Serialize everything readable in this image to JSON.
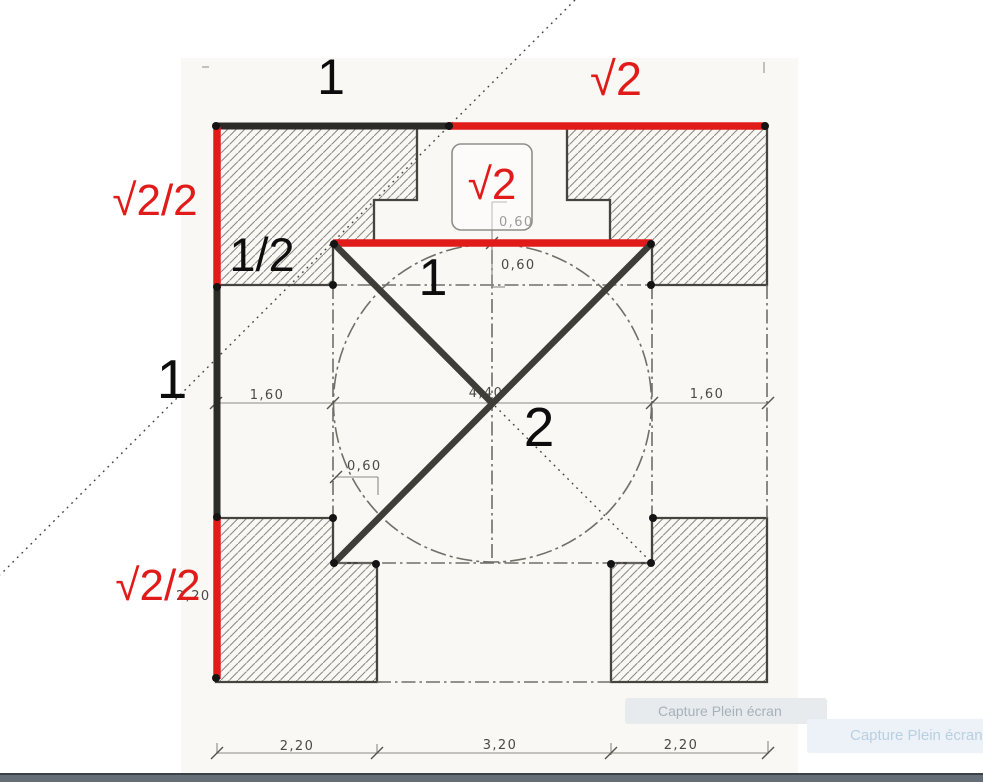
{
  "title": "Plan geometry analysis (square, circle and diagonals) with proportion annotations",
  "colors": {
    "paper": "#faf8f4",
    "annotation_red": "#e11a1a",
    "annotation_black": "#2b2b28",
    "diagonal_dark": "#3e3d38",
    "block_outline": "#45453f",
    "hatch_line": "#8b8b84",
    "dashdot": "#6f6f68",
    "thin_dim": "#8a8a83",
    "dim_text": "#4a4a45",
    "dot": "#141414"
  },
  "math_labels": [
    {
      "name": "label-one-top",
      "text": "1",
      "x": 331,
      "y": 94,
      "size": 50,
      "color": "black"
    },
    {
      "name": "label-sqrt2-top",
      "text": "√2",
      "x": 616,
      "y": 95,
      "size": 47,
      "color": "red"
    },
    {
      "name": "label-sqrt2-half-upper",
      "text": "√2/2",
      "x": 155,
      "y": 215,
      "size": 44,
      "color": "red"
    },
    {
      "name": "label-one-half",
      "text": "1/2",
      "x": 262,
      "y": 271,
      "size": 47,
      "color": "black"
    },
    {
      "name": "label-sqrt2-boxed",
      "text": "√2",
      "x": 492,
      "y": 199,
      "size": 44,
      "color": "red"
    },
    {
      "name": "label-one-inner",
      "text": "1",
      "x": 433,
      "y": 295,
      "size": 52,
      "color": "black"
    },
    {
      "name": "label-one-left",
      "text": "1",
      "x": 172,
      "y": 398,
      "size": 55,
      "color": "black"
    },
    {
      "name": "label-two-center",
      "text": "2",
      "x": 539,
      "y": 446,
      "size": 55,
      "color": "black"
    },
    {
      "name": "label-sqrt2-half-lower",
      "text": "√2/2",
      "x": 158,
      "y": 600,
      "size": 44,
      "color": "red"
    }
  ],
  "dim_labels": [
    {
      "text": "2,20",
      "x": 176,
      "y": 600,
      "anchor": "start"
    },
    {
      "text": "0,60",
      "x": 499,
      "y": 226,
      "anchor": "start"
    },
    {
      "text": "0,60",
      "x": 501,
      "y": 269,
      "anchor": "start"
    },
    {
      "text": "1,60",
      "x": 267,
      "y": 399,
      "anchor": "middle"
    },
    {
      "text": "4,40",
      "x": 486,
      "y": 397,
      "anchor": "middle"
    },
    {
      "text": "1,60",
      "x": 707,
      "y": 398,
      "anchor": "middle"
    },
    {
      "text": "0,60",
      "x": 347,
      "y": 470,
      "anchor": "start"
    },
    {
      "text": "2,20",
      "x": 297,
      "y": 750,
      "anchor": "middle"
    },
    {
      "text": "3,20",
      "x": 500,
      "y": 749,
      "anchor": "middle"
    },
    {
      "text": "2,20",
      "x": 681,
      "y": 749,
      "anchor": "middle"
    },
    {
      "text": "7,60",
      "x": 493,
      "y": 787,
      "anchor": "middle"
    }
  ],
  "plan": {
    "paper_rect": [
      181,
      58,
      617,
      717
    ],
    "blocks": {
      "top-left": [
        [
          216,
          127
        ],
        [
          417,
          127
        ],
        [
          417,
          200
        ],
        [
          374,
          200
        ],
        [
          374,
          243
        ],
        [
          333,
          243
        ],
        [
          333,
          285
        ],
        [
          216,
          285
        ]
      ],
      "top-right": [
        [
          567,
          127
        ],
        [
          767,
          127
        ],
        [
          767,
          285
        ],
        [
          652,
          285
        ],
        [
          652,
          243
        ],
        [
          610,
          243
        ],
        [
          610,
          200
        ],
        [
          567,
          200
        ]
      ],
      "bottom-left": [
        [
          216,
          518
        ],
        [
          333,
          518
        ],
        [
          333,
          563
        ],
        [
          377,
          563
        ],
        [
          377,
          682
        ],
        [
          216,
          682
        ]
      ],
      "bottom-right": [
        [
          652,
          518
        ],
        [
          767,
          518
        ],
        [
          767,
          682
        ],
        [
          611,
          682
        ],
        [
          611,
          563
        ],
        [
          652,
          563
        ]
      ]
    },
    "circle": {
      "cx": 492.5,
      "cy": 403,
      "r": 159
    },
    "dashdot_lines": [
      [
        333,
        285,
        333,
        518
      ],
      [
        652,
        285,
        652,
        518
      ],
      [
        492,
        250,
        492,
        560
      ],
      [
        333,
        285,
        652,
        285
      ],
      [
        333,
        563,
        652,
        563
      ],
      [
        377,
        682,
        611,
        682
      ],
      [
        767,
        285,
        767,
        518
      ]
    ],
    "thin_lines": [
      [
        216,
        403,
        768,
        403
      ],
      [
        492,
        202,
        492,
        287
      ],
      [
        492,
        202,
        507,
        202
      ],
      [
        492,
        287,
        505,
        287
      ],
      [
        335,
        477,
        378,
        477
      ],
      [
        378,
        477,
        378,
        495
      ],
      [
        216,
        753,
        768,
        753
      ],
      [
        217,
        743,
        217,
        754
      ],
      [
        377,
        744,
        377,
        754
      ],
      [
        611,
        743,
        611,
        755
      ],
      [
        768,
        741,
        768,
        754
      ]
    ],
    "slash_ticks": [
      [
        216,
        403
      ],
      [
        333,
        403
      ],
      [
        652,
        403
      ],
      [
        768,
        403
      ],
      [
        492,
        243
      ],
      [
        336,
        477
      ],
      [
        217,
        753
      ],
      [
        377,
        753
      ],
      [
        611,
        753
      ],
      [
        768,
        753
      ]
    ],
    "dots": [
      [
        216,
        126
      ],
      [
        449,
        126
      ],
      [
        765,
        126
      ],
      [
        217,
        287
      ],
      [
        217,
        517
      ],
      [
        216,
        678
      ],
      [
        334,
        244
      ],
      [
        651,
        244
      ],
      [
        333,
        285
      ],
      [
        651,
        285
      ],
      [
        333,
        518
      ],
      [
        653,
        518
      ],
      [
        334,
        563
      ],
      [
        651,
        563
      ],
      [
        376,
        564
      ],
      [
        611,
        564
      ]
    ],
    "misc_ticks": [
      [
        764,
        62,
        764,
        73
      ],
      [
        202,
        67,
        209,
        67
      ]
    ]
  },
  "annotations": {
    "black_lines": [
      [
        214,
        126,
        450,
        126
      ],
      [
        217,
        285,
        217,
        518
      ]
    ],
    "red_lines": [
      [
        448,
        126,
        766,
        126
      ],
      [
        333,
        243,
        652,
        243
      ],
      [
        217,
        127,
        217,
        288
      ],
      [
        217,
        516,
        217,
        679
      ]
    ],
    "thick_diagonals": [
      [
        335,
        245,
        490,
        401
      ],
      [
        650,
        245,
        336,
        561
      ]
    ],
    "dotted_diagonals": [
      [
        575,
        0,
        0,
        575
      ],
      [
        495,
        406,
        650,
        561
      ]
    ],
    "sqrt2_box": {
      "x": 452,
      "y": 144,
      "w": 80,
      "h": 86,
      "rx": 9
    }
  },
  "capture_overlays": [
    {
      "label": "Capture Plein écran"
    },
    {
      "label": "Capture Plein écran"
    }
  ]
}
